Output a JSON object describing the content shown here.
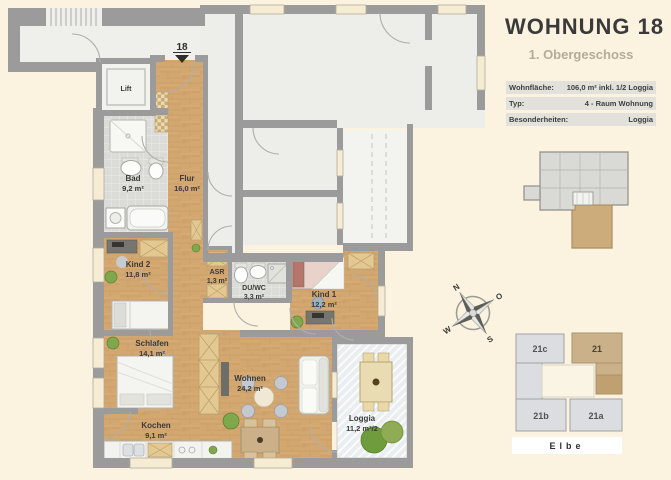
{
  "header": {
    "title": "WOHNUNG 18",
    "subtitle": "1. Obergeschoss"
  },
  "info_table": {
    "rows": [
      {
        "label": "Wohnfläche:",
        "value": "106,0 m² inkl. 1/2 Loggia"
      },
      {
        "label": "Typ:",
        "value": "4 - Raum Wohnung"
      },
      {
        "label": "Besonderheiten:",
        "value": "Loggia"
      }
    ]
  },
  "floorplan": {
    "entrance_marker": "18",
    "rooms": [
      {
        "name": "Lift",
        "area": ""
      },
      {
        "name": "Bad",
        "area": "9,2 m²"
      },
      {
        "name": "Flur",
        "area": "16,0 m²"
      },
      {
        "name": "Kind 2",
        "area": "11,8 m²"
      },
      {
        "name": "ASR",
        "area": "1,3 m²"
      },
      {
        "name": "DU/WC",
        "area": "3,3 m²"
      },
      {
        "name": "Kind 1",
        "area": "12,2 m²"
      },
      {
        "name": "Schlafen",
        "area": "14,1 m²"
      },
      {
        "name": "Wohnen",
        "area": "24,2 m²"
      },
      {
        "name": "Kochen",
        "area": "9,1 m²"
      },
      {
        "name": "Loggia",
        "area": "11,2 m²/2"
      }
    ]
  },
  "compass": {
    "n": "N",
    "o": "O",
    "s": "S",
    "w": "W"
  },
  "site_map": {
    "buildings": [
      {
        "label": "21c"
      },
      {
        "label": "21"
      },
      {
        "label": "21b"
      },
      {
        "label": "21a"
      }
    ],
    "highlighted": "21",
    "river_label": "Elbe"
  },
  "colors": {
    "background": "#FBF2DF",
    "wall": "#9B9B9B",
    "wood_floor": "#D3A770",
    "tile_floor": "#DBDBD7",
    "neighbor_floor": "#EDEDEA",
    "highlight_tan": "#CDAC7C",
    "title_text": "#3A3A3A",
    "subtitle_text": "#B5AB9B"
  }
}
